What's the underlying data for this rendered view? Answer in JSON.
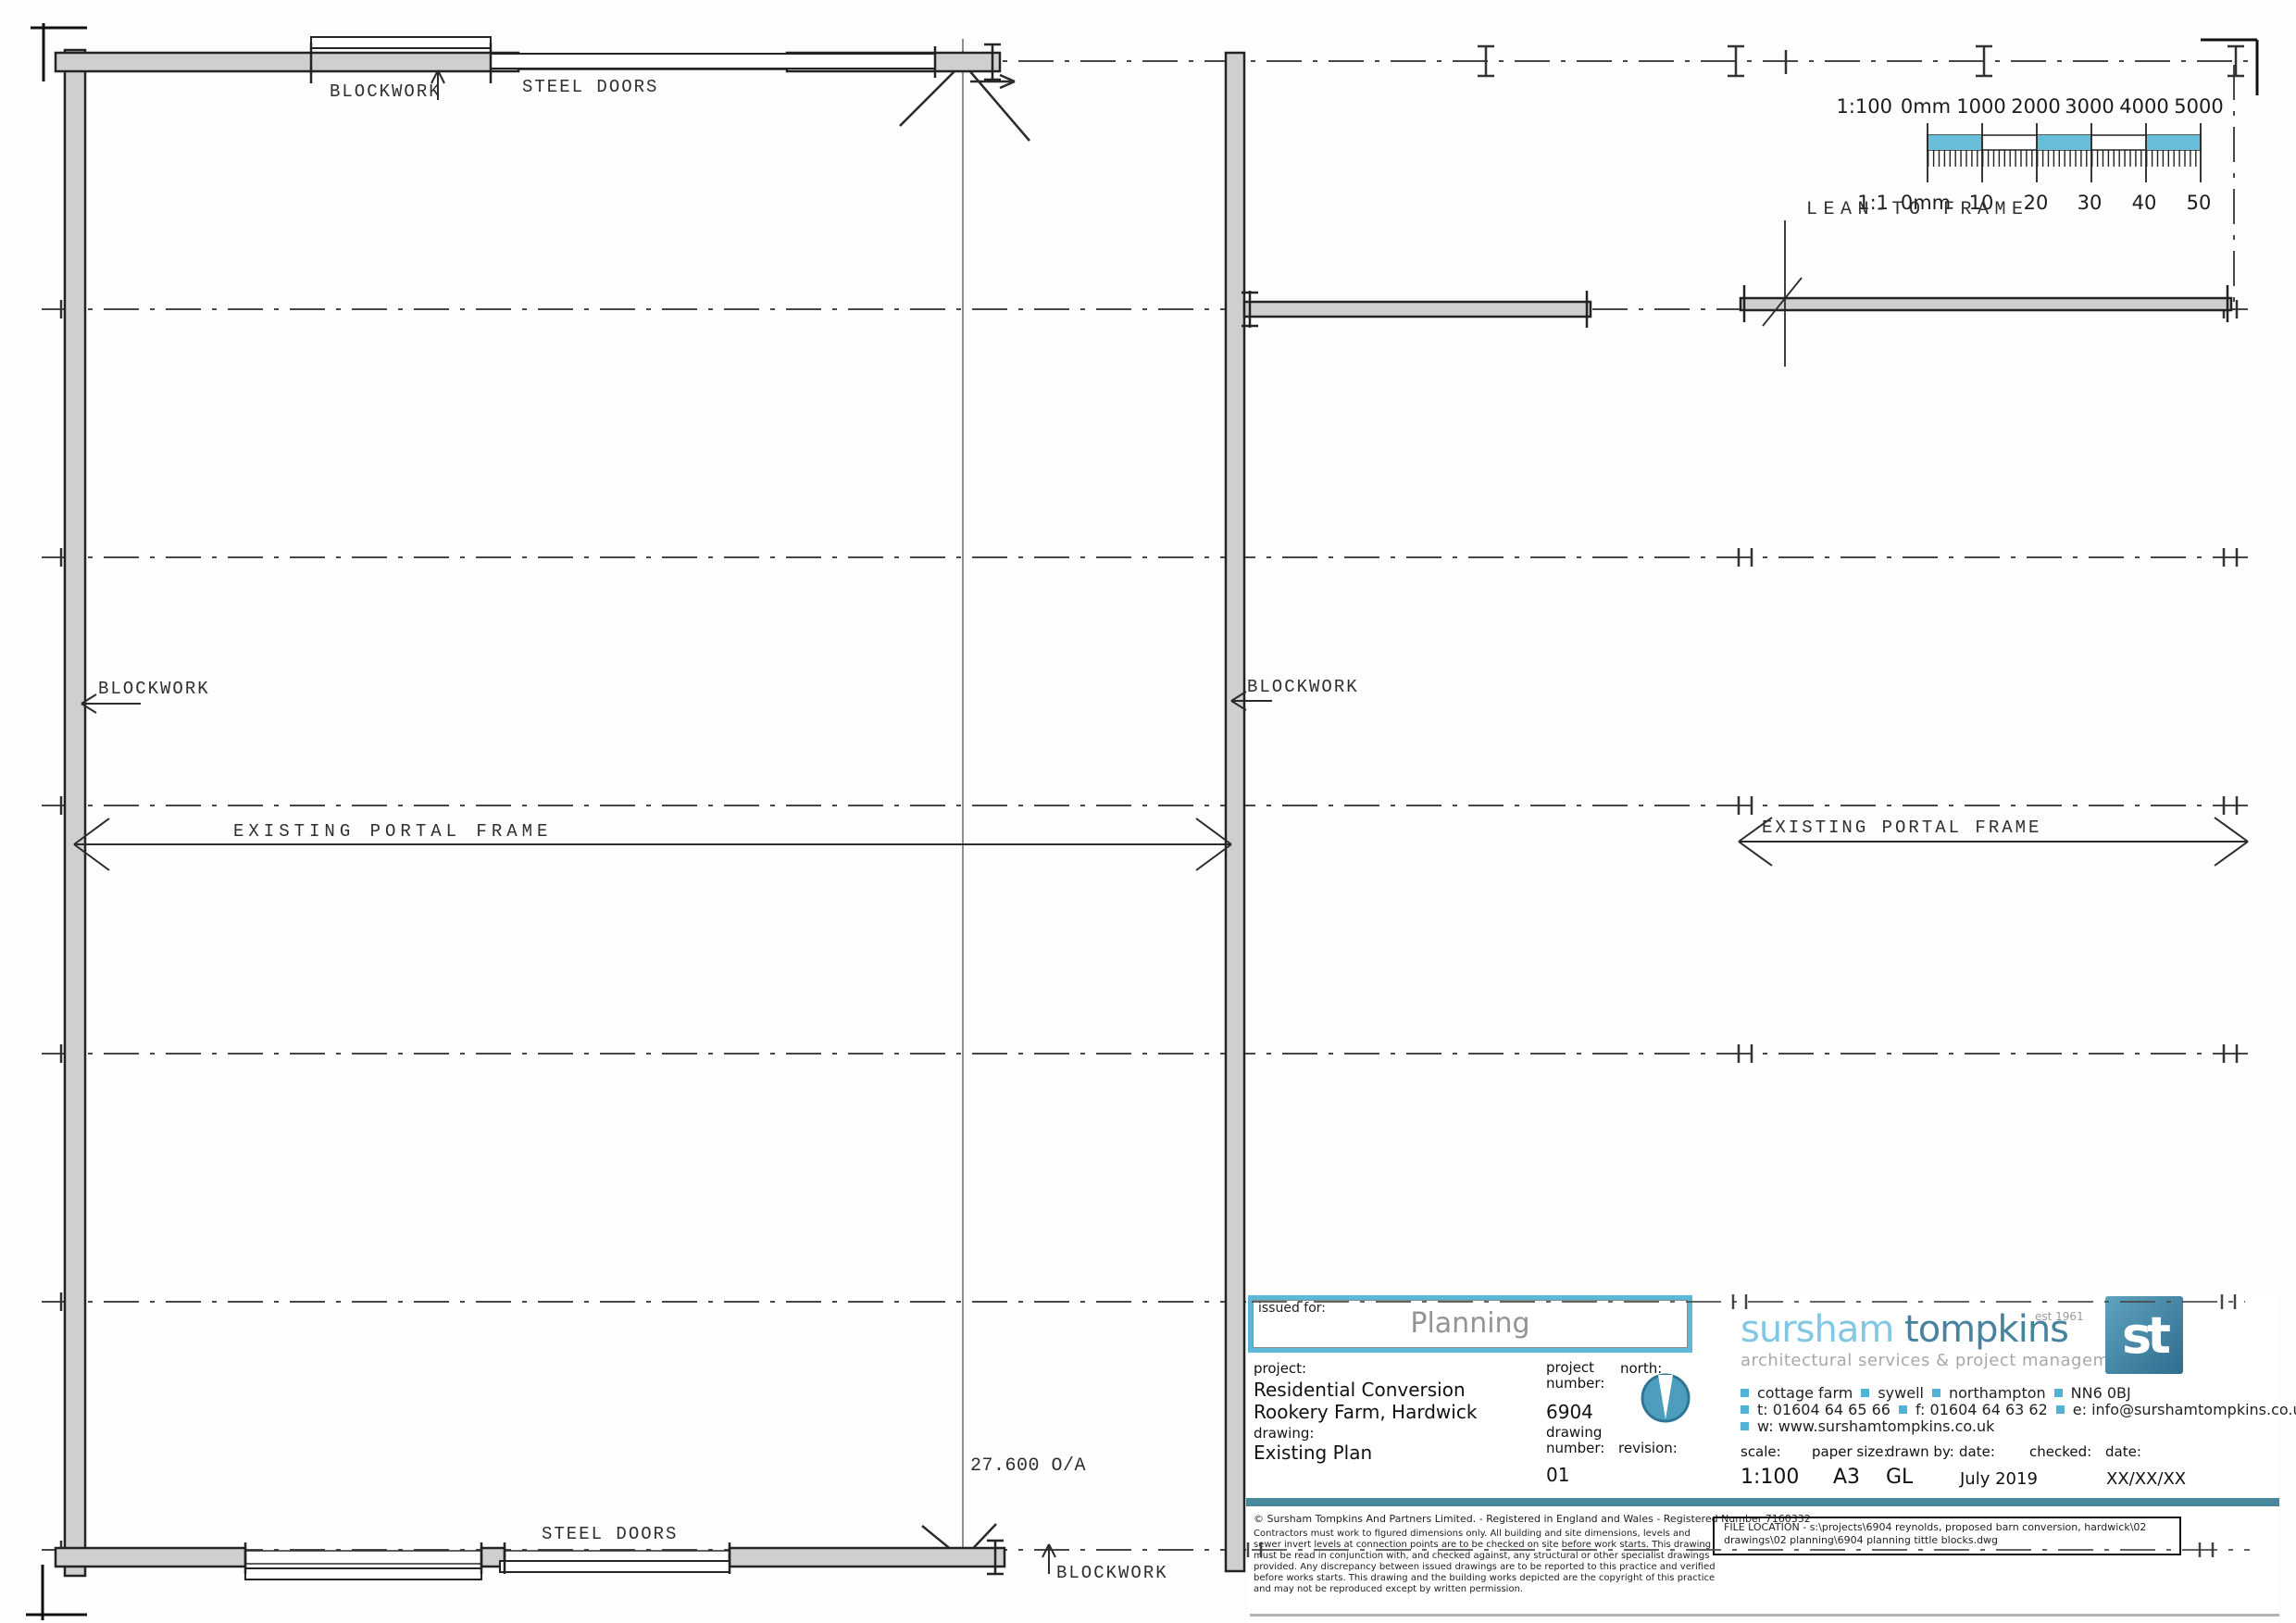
{
  "plan": {
    "labels": {
      "blockwork_top": "BLOCKWORK",
      "steel_doors_top": "STEEL DOORS",
      "blockwork_left": "BLOCKWORK",
      "blockwork_mid": "BLOCKWORK",
      "portal_frame_left": "EXISTING PORTAL FRAME",
      "portal_frame_right": "EXISTING PORTAL FRAME",
      "lean_to": "LEAN-TO FRAME",
      "overall_dim": "27.600 O/A",
      "steel_doors_bottom": "STEEL DOORS",
      "blockwork_bottom": "BLOCKWORK"
    }
  },
  "scale_bar": {
    "row_1100": [
      "1:100",
      "0mm",
      "1000",
      "2000",
      "3000",
      "4000",
      "5000"
    ],
    "row_11": [
      "1:1",
      "0mm",
      "10",
      "20",
      "30",
      "40",
      "50"
    ]
  },
  "title_block": {
    "issued_for_label": "issued for:",
    "issued_for_value": "Planning",
    "project_label": "project:",
    "project_line1": "Residential Conversion",
    "project_line2": "Rookery Farm, Hardwick",
    "drawing_label": "drawing:",
    "drawing_value": "Existing Plan",
    "project_number_label": "project number:",
    "project_number": "6904",
    "drawing_number_label": "drawing number:",
    "drawing_number": "01",
    "north_label": "north:",
    "revision_label": "revision:",
    "brand": {
      "name_1": "sursham",
      "name_2": " tompkins",
      "est": "est 1961",
      "tagline": "architectural services & project management",
      "monogram": "st"
    },
    "contact": {
      "address_items": [
        "cottage farm",
        "sywell",
        "northampton",
        "NN6 0BJ"
      ],
      "tel": "t: 01604 64 65 66",
      "fax": "f: 01604 64 63 62",
      "email": "e: info@surshamtompkins.co.uk",
      "web": "w: www.surshamtompkins.co.uk"
    },
    "meta": {
      "scale_label": "scale:",
      "scale": "1:100",
      "paper_label": "paper size:",
      "paper": "A3",
      "drawn_label": "drawn by:",
      "drawn": "GL",
      "date_label": "date:",
      "date": "July 2019",
      "checked_label": "checked:",
      "checked_date_label": "date:",
      "checked_date": "XX/XX/XX"
    },
    "legal": {
      "copyright": "©  Sursham Tompkins And Partners Limited. - Registered in England and Wales - Registered Number 7160332",
      "disclaimer": "Contractors must work to figured dimensions only. All building and site dimensions, levels and sewer invert levels at connection points are to be checked on site before work starts. This drawing must be read in conjunction with, and checked against, any structural or other specialist drawings provided. Any discrepancy between issued drawings are to be reported to this practice and verified before works starts. This drawing and the building works depicted are the copyright of this practice and may not be reproduced except by written permission.",
      "file_location": "FILE LOCATION -  s:\\projects\\6904 reynolds, proposed barn conversion, hardwick\\02 drawings\\02 planning\\6904 planning tittle blocks.dwg"
    }
  },
  "colors": {
    "accent_blue": "#5cb8d8",
    "brand_light_blue": "#82c7e3",
    "brand_dark_teal": "#47829e",
    "teal_bar": "#48879c",
    "scale_bar_blue": "#68bed9"
  }
}
